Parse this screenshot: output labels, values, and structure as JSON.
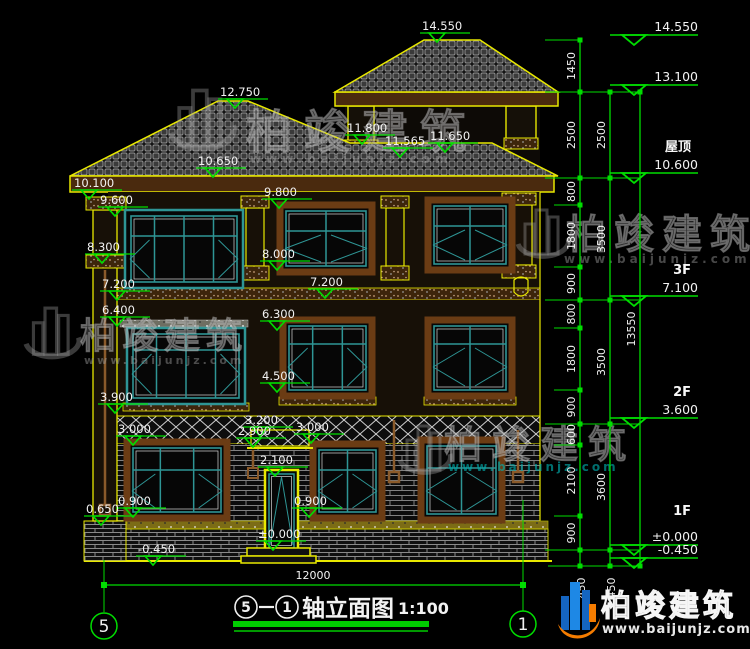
{
  "title_block": {
    "axis_from": "5",
    "axis_to": "1",
    "name": "轴立面图",
    "scale": "1:100"
  },
  "axis_bubbles": {
    "left": "5",
    "right": "1"
  },
  "dims": {
    "overall": "12000"
  },
  "watermark": {
    "brand": "柏竣建筑",
    "url": "www.baijunjz.com"
  },
  "footer_logo": {
    "brand": "柏竣建筑",
    "url": "www.baijunjz.com"
  },
  "elevation_markers": [
    {
      "label": "14.550",
      "x": 420,
      "y": 33
    },
    {
      "label": "12.750",
      "x": 218,
      "y": 99
    },
    {
      "label": "11.800",
      "x": 345,
      "y": 135
    },
    {
      "label": "11.565",
      "x": 383,
      "y": 148
    },
    {
      "label": "11.650",
      "x": 428,
      "y": 143
    },
    {
      "label": "10.650",
      "x": 196,
      "y": 168
    },
    {
      "label": "10.100",
      "x": 72,
      "y": 190
    },
    {
      "label": "9.600",
      "x": 98,
      "y": 207
    },
    {
      "label": "9.800",
      "x": 262,
      "y": 199
    },
    {
      "label": "8.300",
      "x": 85,
      "y": 254
    },
    {
      "label": "8.000",
      "x": 260,
      "y": 261
    },
    {
      "label": "7.200",
      "x": 100,
      "y": 291
    },
    {
      "label": "7.200",
      "x": 308,
      "y": 289
    },
    {
      "label": "6.400",
      "x": 100,
      "y": 317
    },
    {
      "label": "6.300",
      "x": 260,
      "y": 321
    },
    {
      "label": "4.500",
      "x": 260,
      "y": 383
    },
    {
      "label": "3.900",
      "x": 98,
      "y": 404
    },
    {
      "label": "3.000",
      "x": 116,
      "y": 436
    },
    {
      "label": "3.200",
      "x": 243,
      "y": 427
    },
    {
      "label": "2.900",
      "x": 236,
      "y": 438
    },
    {
      "label": "3.000",
      "x": 294,
      "y": 434
    },
    {
      "label": "2.100",
      "x": 258,
      "y": 467
    },
    {
      "label": "0.900",
      "x": 116,
      "y": 508
    },
    {
      "label": "0.650",
      "x": 84,
      "y": 516
    },
    {
      "label": "0.900",
      "x": 292,
      "y": 508
    },
    {
      "label": "±0.000",
      "x": 256,
      "y": 541
    },
    {
      "label": "-0.450",
      "x": 136,
      "y": 556
    }
  ],
  "right_markers": [
    {
      "name": "",
      "value": "14.550",
      "y": 35
    },
    {
      "name": "",
      "value": "13.100",
      "y": 85
    },
    {
      "name": "屋顶",
      "value": "10.600",
      "y": 173
    },
    {
      "name": "3F",
      "value": "7.100",
      "y": 296
    },
    {
      "name": "2F",
      "value": "3.600",
      "y": 418
    },
    {
      "name": "1F",
      "value": "±0.000",
      "y": 545,
      "name_dy": -30
    },
    {
      "name": "",
      "value": "-0.450",
      "y": 558
    }
  ],
  "dim_chains": [
    {
      "x": 580,
      "segments": [
        {
          "label": "1450",
          "y1": 40,
          "y2": 92
        },
        {
          "label": "2500",
          "y1": 92,
          "y2": 178
        },
        {
          "label": "800",
          "y1": 178,
          "y2": 205
        },
        {
          "label": "1800",
          "y1": 205,
          "y2": 267
        },
        {
          "label": "900",
          "y1": 267,
          "y2": 300
        },
        {
          "label": "800",
          "y1": 300,
          "y2": 328
        },
        {
          "label": "1800",
          "y1": 328,
          "y2": 390
        },
        {
          "label": "900",
          "y1": 390,
          "y2": 424
        },
        {
          "label": "600",
          "y1": 424,
          "y2": 445
        },
        {
          "label": "2100",
          "y1": 445,
          "y2": 516
        },
        {
          "label": "900",
          "y1": 516,
          "y2": 550
        },
        {
          "label": "450",
          "y1": 550,
          "y2": 566,
          "below": true
        }
      ]
    },
    {
      "x": 610,
      "segments": [
        {
          "label": "2500",
          "y1": 92,
          "y2": 178
        },
        {
          "label": "3500",
          "y1": 178,
          "y2": 300
        },
        {
          "label": "3500",
          "y1": 300,
          "y2": 424
        },
        {
          "label": "3600",
          "y1": 424,
          "y2": 550
        },
        {
          "label": "450",
          "y1": 550,
          "y2": 566,
          "below": true
        }
      ]
    },
    {
      "x": 640,
      "segments": [
        {
          "label": "13550",
          "y1": 92,
          "y2": 566
        }
      ]
    }
  ]
}
